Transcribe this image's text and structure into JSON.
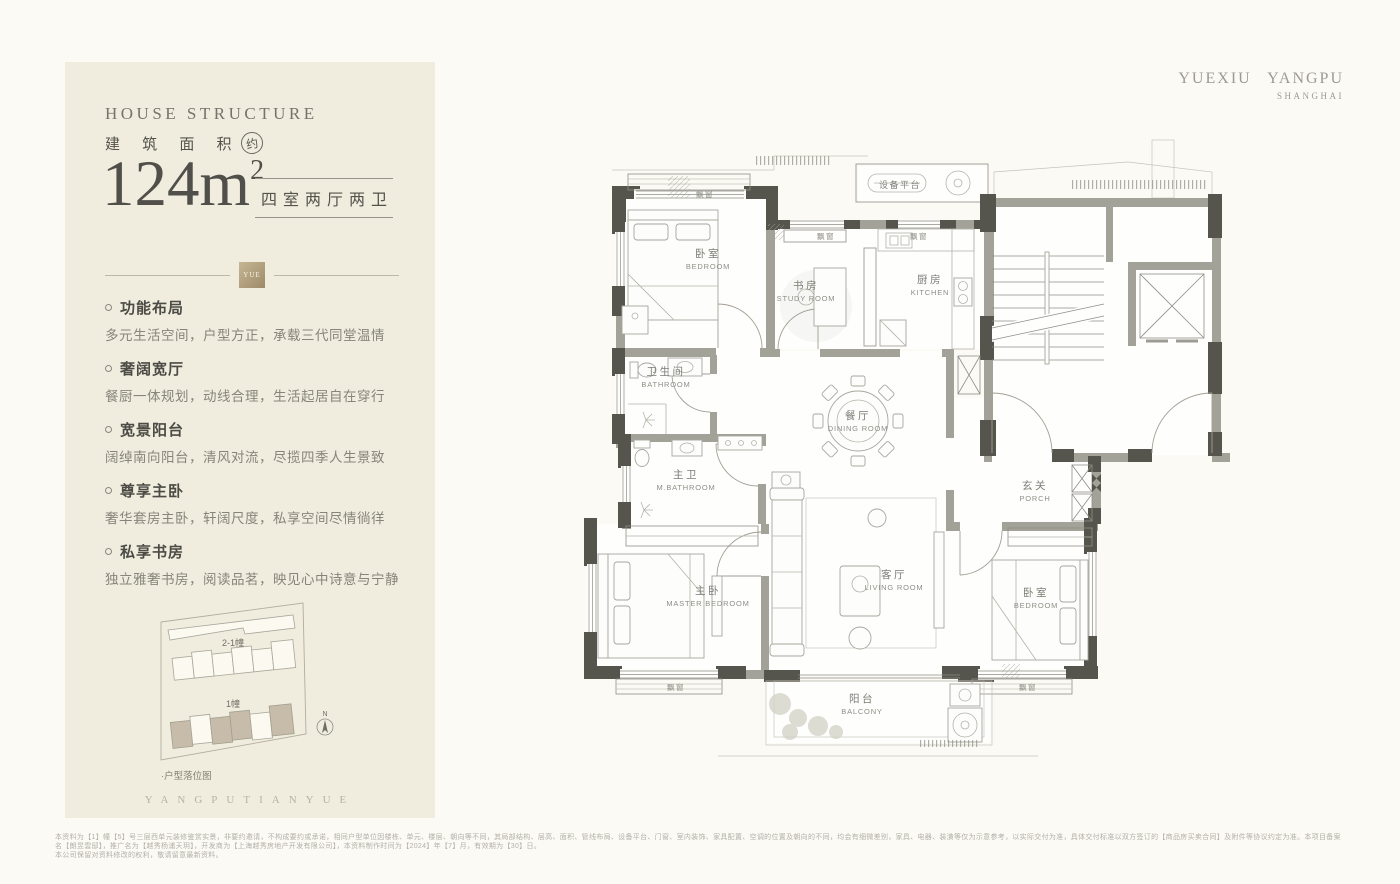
{
  "logo": {
    "line1": "YUEXIU YANGPU",
    "line2": "SHANGHAI"
  },
  "panel": {
    "eyebrow": "HOUSE STRUCTURE",
    "area_label": "建 筑 面 积",
    "area_approx": "约",
    "area_value": "124m",
    "area_sup": "2",
    "unit_type": "四室两厅两卫",
    "badge": "YUE",
    "features": [
      {
        "title": "功能布局",
        "desc": "多元生活空间，户型方正，承载三代同堂温情"
      },
      {
        "title": "奢阔宽厅",
        "desc": "餐厨一体规划，动线合理，生活起居自在穿行"
      },
      {
        "title": "宽景阳台",
        "desc": "阔绰南向阳台，清风对流，尽揽四季人生景致"
      },
      {
        "title": "尊享主卧",
        "desc": "奢华套房主卧，轩阔尺度，私享空间尽情徜徉"
      },
      {
        "title": "私享书房",
        "desc": "独立雅奢书房，阅读品茗，映见心中诗意与宁静"
      }
    ],
    "siteplan": {
      "building_top": "2-1幢",
      "building_bottom": "1幢",
      "compass": "N",
      "caption": "·户型落位图"
    },
    "watermark": "YANGPUTIANYUE"
  },
  "plan": {
    "rooms": [
      {
        "zh": "卧室",
        "en": "BEDROOM"
      },
      {
        "zh": "书房",
        "en": "STUDY ROOM"
      },
      {
        "zh": "厨房",
        "en": "KITCHEN"
      },
      {
        "zh": "卫生间",
        "en": "BATHROOM"
      },
      {
        "zh": "餐厅",
        "en": "DINING ROOM"
      },
      {
        "zh": "主卫",
        "en": "M.BATHROOM"
      },
      {
        "zh": "主卧",
        "en": "MASTER BEDROOM"
      },
      {
        "zh": "客厅",
        "en": "LIVING ROOM"
      },
      {
        "zh": "卧室",
        "en": "BEDROOM"
      },
      {
        "zh": "玄关",
        "en": "PORCH"
      },
      {
        "zh": "阳台",
        "en": "BALCONY"
      }
    ],
    "annotations": {
      "equipment": "设备平台",
      "bay_window": "飘窗"
    }
  },
  "footer": {
    "line1": "本资料为【1】幢【5】号三层西单元装修鉴赏实景，非要约邀请，不构成要约或承诺，相同户型单位因楼栋、单元、楼层、朝向等不同，其局部结构、层高、面积、管线布局、设备平台、门窗、室内装饰、家具配置、空调的位置及朝向的不同，均会有细微差别，家具、电器、装潢等仅为示意参考，以实际交付为准，具体交付标准以双方签订的【商品房买卖合同】及附件等协议约定为准。本项目备案名【朗昱雲邸】，推广名为【越秀杨浦天玥】，开发商为【上海越秀房地产开发有限公司】，本资料制作时间为【2024】年【7】月，有效期为【30】日。",
    "line2": "本公司保留对资料修改的权利，敬请留意最新资料。"
  }
}
